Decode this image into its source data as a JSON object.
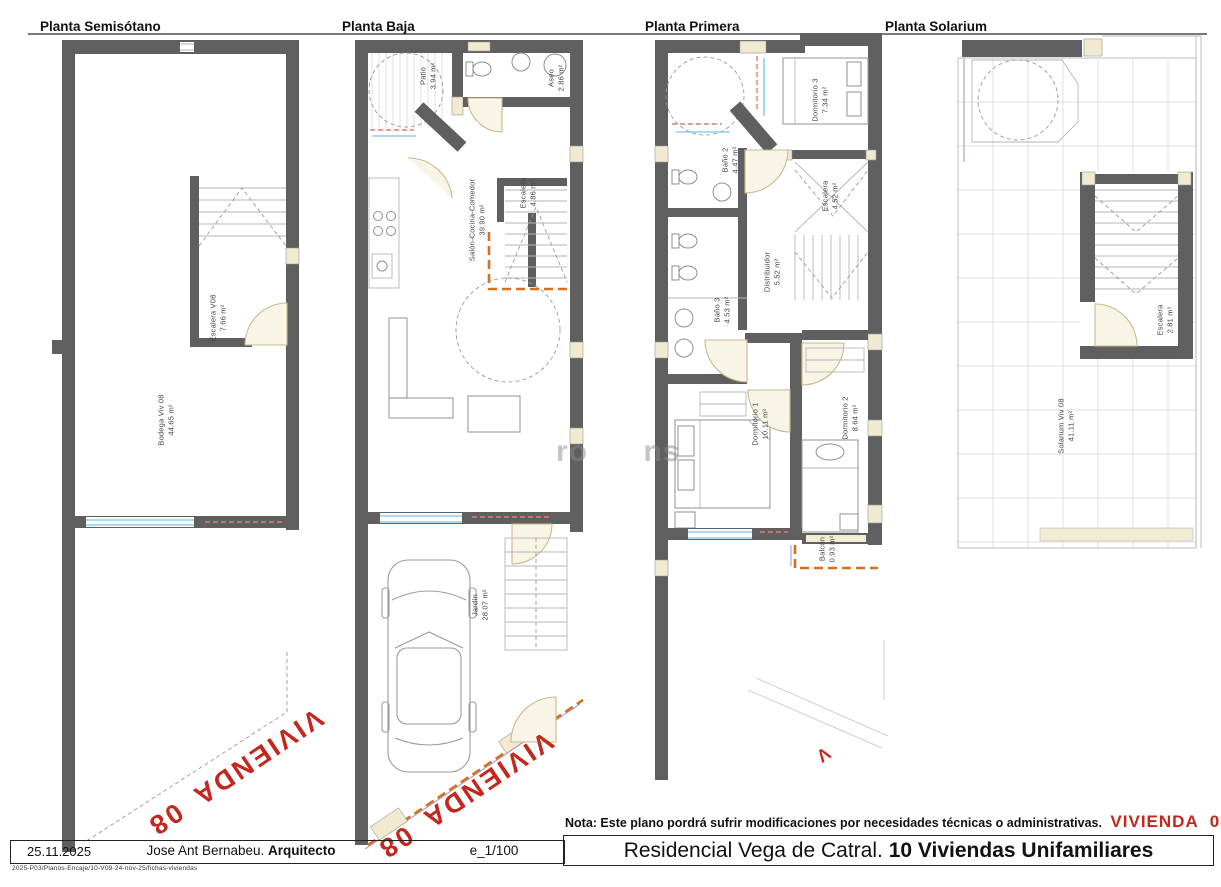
{
  "plans": [
    {
      "title": "Planta Semisótano",
      "rooms": [
        {
          "name": "Escalera V08",
          "area": "7.66 m²"
        },
        {
          "name": "Bodega Viv 08",
          "area": "44.65 m²"
        }
      ]
    },
    {
      "title": "Planta Baja",
      "rooms": [
        {
          "name": "Patio",
          "area": "3.94 m²"
        },
        {
          "name": "Aseo",
          "area": "2.86 m²"
        },
        {
          "name": "Salón-Cocina-Comedor",
          "area": "39.90 m²"
        },
        {
          "name": "Escalera",
          "area": "4.86 m²"
        },
        {
          "name": "Jardín",
          "area": "28.07 m²"
        }
      ]
    },
    {
      "title": "Planta Primera",
      "rooms": [
        {
          "name": "Dormitorio 3",
          "area": "7.34 m²"
        },
        {
          "name": "Baño 2",
          "area": "4.47 m²"
        },
        {
          "name": "Escalera",
          "area": "4.52 m²"
        },
        {
          "name": "Distribuidor",
          "area": "5.52 m²"
        },
        {
          "name": "Baño 3",
          "area": "4.53 m²"
        },
        {
          "name": "Dormitorio 1",
          "area": "10.11 m²"
        },
        {
          "name": "Dormitorio 2",
          "area": "8.64 m²"
        },
        {
          "name": "Balcón",
          "area": "0.93 m²"
        }
      ]
    },
    {
      "title": "Planta Solarium",
      "rooms": [
        {
          "name": "Escalera",
          "area": "2.81 m²"
        },
        {
          "name": "Solarium Viv 08",
          "area": "41.11 m²"
        }
      ]
    }
  ],
  "marks": {
    "vivienda": "VIVIENDA 08",
    "partial": "V"
  },
  "note": {
    "text": "Nota: Este plano pordrá sufrir modificaciones por necesidades técnicas o administrativas.",
    "vivienda": "VIVIENDA  08"
  },
  "titleblock": {
    "date": "25.11.2025",
    "architect": "Jose Ant Bernabeu.",
    "architect_bold": "Arquitecto",
    "scale": "e_1/100",
    "project": "Residencial Vega de Catral.",
    "project_bold": "10 Viviendas Unifamiliares",
    "file_ref": "2025-P03/Planos-Encaje/10-V09-24-nov-25/fichas-viviendas"
  },
  "watermark": {
    "frag1": "ro",
    "frag2": "ns"
  },
  "colors": {
    "wall": "#5f5f5f",
    "accent_red": "#c3271d",
    "orange_dash": "#d2711f",
    "window_blue": "#8ecef0",
    "window_red": "#e07a7a",
    "lavender": "#b49fd8",
    "door_cream": "#f1ead0"
  }
}
